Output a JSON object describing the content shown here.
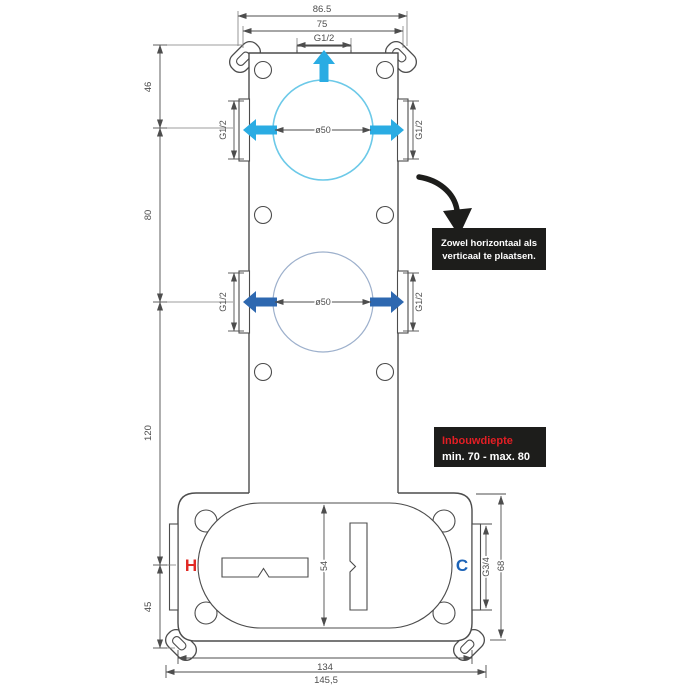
{
  "top_dims": {
    "outer": "86.5",
    "inner": "75",
    "port": "G1/2"
  },
  "left_dims": {
    "d46": "46",
    "d80": "80",
    "d120": "120",
    "d45": "45"
  },
  "upper_group": {
    "diameter": "ø50",
    "left_port": "G1/2",
    "right_port": "G1/2"
  },
  "lower_group": {
    "diameter": "ø50",
    "left_port": "G1/2",
    "right_port": "G1/2"
  },
  "bottom_box": {
    "hot": "H",
    "cold": "C",
    "slot_height": "54",
    "right_port": "G3/4",
    "height": "68",
    "width_inner": "134",
    "width_outer": "145,5"
  },
  "notes": {
    "placement": {
      "line1": "Zowel horizontaal als",
      "line2": "verticaal te plaatsen."
    },
    "depth": {
      "title": "Inbouwdiepte",
      "range": "min. 70 - max. 80"
    }
  },
  "colors": {
    "line": "#4c4c4c",
    "flow_top": "#2aace3",
    "flow_bottom": "#2e68b0",
    "circle_top": "#6cc9e8",
    "circle_bottom": "#9db0cc",
    "hot": "#e12a25",
    "cold": "#1c63b7",
    "note_bg": "#1d1d1b",
    "depth_title": "#e31e24"
  }
}
